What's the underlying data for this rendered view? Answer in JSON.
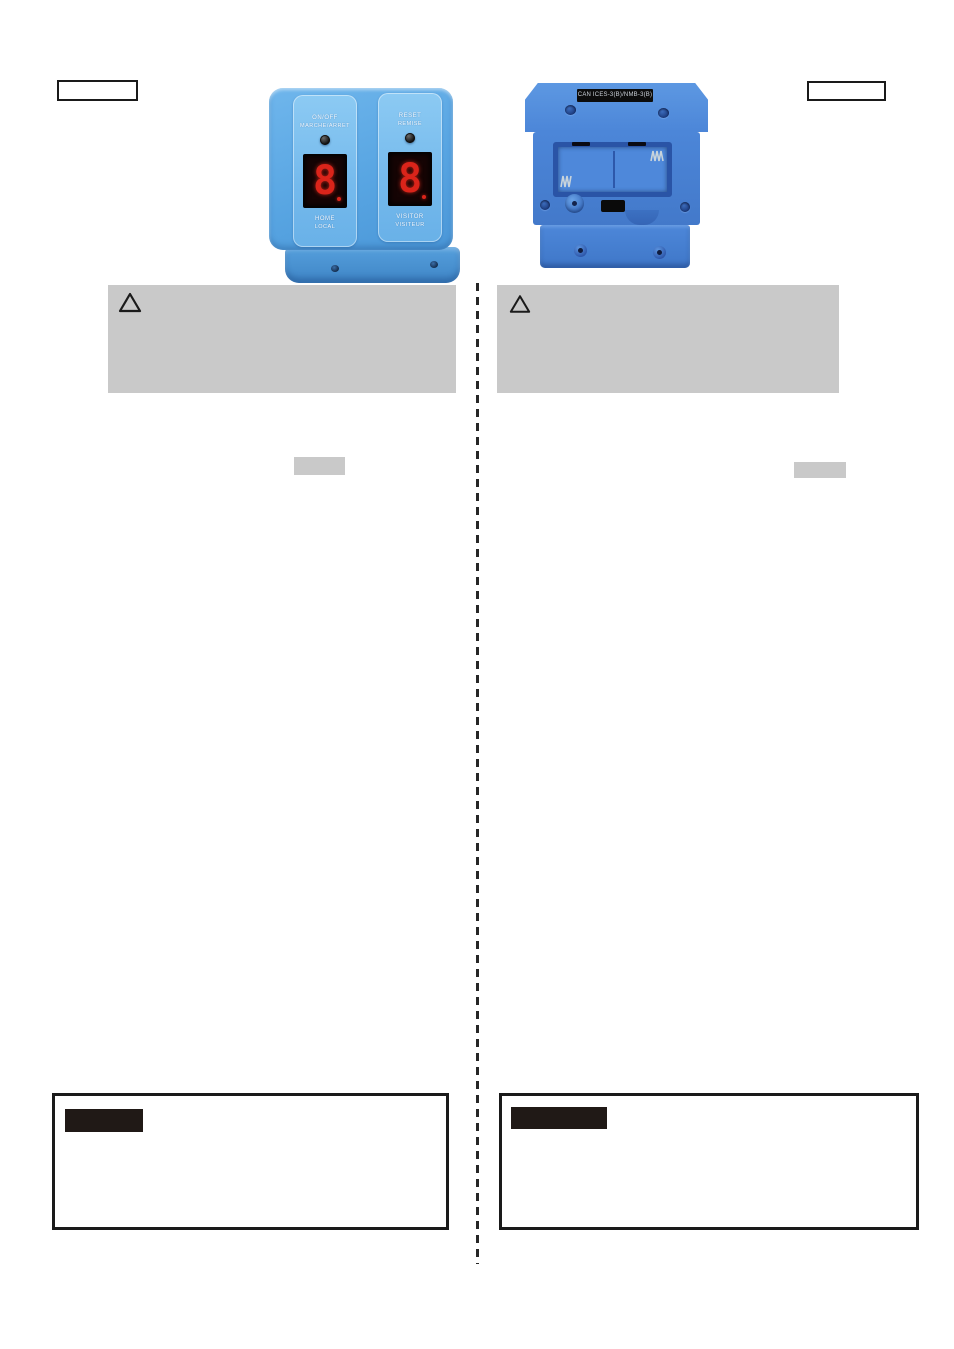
{
  "page": {
    "background": "#ffffff"
  },
  "top_boxes": {
    "left_label": "",
    "right_label": ""
  },
  "controller_front": {
    "name": "scoreboard controller front",
    "colors": {
      "body": "#5ea9e6",
      "panel": "#7cc0ef",
      "display_bg": "#150404",
      "digit": "#d8231b"
    },
    "left_panel": {
      "label_line1": "ON/OFF",
      "label_line2": "MARCHE/ARRET",
      "digit": "8",
      "footer_line1": "HOME",
      "footer_line2": "LOCAL"
    },
    "right_panel": {
      "label_line1": "RESET",
      "label_line2": "REMISE",
      "digit": "8",
      "footer_line1": "VISITOR",
      "footer_line2": "VISITEUR"
    }
  },
  "controller_back": {
    "name": "scoreboard controller back with battery compartment",
    "compliance_label": "CAN ICES-3(B)/NMB-3(B)",
    "colors": {
      "body": "#4c86d8",
      "label_bg": "#0c0c0c",
      "label_text": "#ccd2da"
    }
  },
  "warning_boxes": {
    "background": "#c9c9c9",
    "icon": "warning-triangle",
    "left_text": "",
    "right_text": ""
  },
  "divider": {
    "style": "dashed-vertical",
    "color": "#262626"
  },
  "placeholders": {
    "small_left": "",
    "small_right": ""
  },
  "note_boxes": {
    "border_color": "#1a1a1a",
    "tag_background": "#201916",
    "left_tag_label": "",
    "right_tag_label": ""
  }
}
